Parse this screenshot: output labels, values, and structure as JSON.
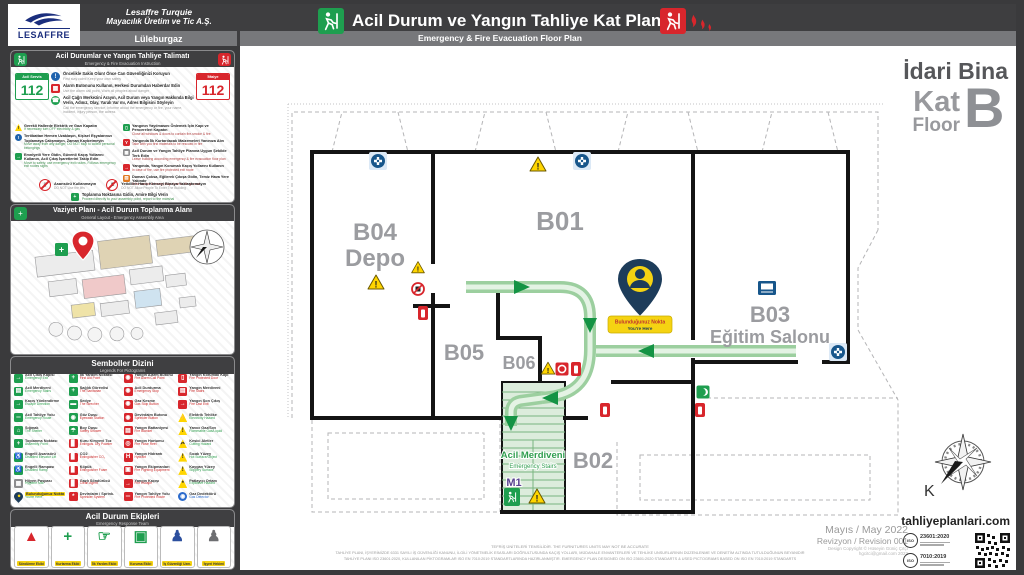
{
  "header": {
    "logo_text": "LESAFFRE",
    "company_line1": "Lesaffre Turquie",
    "company_line2": "Mayacılık Üretim ve Tic A.Ş.",
    "location": "Lüleburgaz",
    "title": "Acil Durum ve Yangın Tahliye Kat Planı",
    "subtitle": "Emergency & Fire Evacuation Floor Plan"
  },
  "building": {
    "name": "İdari Bina",
    "kat": "Kat",
    "floor": "Floor",
    "code": "B"
  },
  "instructions": {
    "title": "Acil Durumlar ve Yangın Tahliye Talimatı",
    "subtitle": "Emergency & Fire Evacuation Instruction",
    "numbers": [
      {
        "label": "Acil Servis",
        "number": "112",
        "c": "#1e9e4f"
      },
      {
        "label": "İtfaiye",
        "number": "112",
        "c": "#d8262c"
      }
    ],
    "steps": [
      {
        "tr": "Öncelikle Sakin Olun! Önce Can Güvenliğinizi Koruyun",
        "en": "First stay calm! Keep your own safety",
        "g": "!",
        "c": "#1f63ad",
        "t": "circ"
      },
      {
        "tr": "Alarm Butonunu Kullanın, Herkesi Durumdan Haberdar Edin",
        "en": "Use the alarm call point, Warn all peoples about danger",
        "g": "▦",
        "c": "#d8262c",
        "t": "sq"
      },
      {
        "tr": "Acil Çağrı Merkezini Arayın, Acil Durum veya Yangın Hakkında Bilgi Verin, Adınız, Olay, Yaralı Var mı, Adres Bilgisini Söyleyin",
        "en": "Call the emergency service, Informe about the emergency or fire, your name, incident, injury person, the adress",
        "g": "☎",
        "c": "#1e9e4f",
        "t": "circ"
      }
    ],
    "notes_left": [
      {
        "tr": "Gerekli Hallerde Elektrik ve Gazı Kapatın",
        "en": "If necessary turn OFF electricity & gas",
        "g": "!",
        "c": "#ffd500",
        "t": "tri"
      },
      {
        "tr": "Tertibattan Hemen Uzaklaşın, Kişisel Eşyalarınızı Toplamaya Çalışmayın, Zaman Kaybetmeyin",
        "en": "Move away from any danger, DO NOT stop to collect personal belongings",
        "g": "!",
        "c": "#1f63ad",
        "t": "circ"
      },
      {
        "tr": "Emniyetli Yere Gidin, Güvenli Kaçış Yollarını Kullanın, Acil Çıkış İşaretlerini Takip Edin",
        "en": "Move to safety, use emergency exit routes, Follows emergency exit routes signs",
        "g": "→",
        "c": "#1e9e4f",
        "t": "sq"
      }
    ],
    "notes_right": [
      {
        "tr": "Yangının Yayılmasını Önlemek İçin Kapı ve Pencereleri Kapatın",
        "en": "Close all windows & doors to contain fire-smoke & fire",
        "g": "▯",
        "c": "#1e9e4f",
        "t": "sq"
      },
      {
        "tr": "Yangında İlk Kurtarılacak Malzemeleri Yanınıza Alın",
        "en": "Take with you first materials to be rescued in fire",
        "g": "Y",
        "c": "#d8262c",
        "t": "sq"
      },
      {
        "tr": "Acil Durum ve Yangın Tahliye Planına Uygun Şekilde Terk Edin",
        "en": "Leave building according emergency & fire evacuation floor plan",
        "g": "▦",
        "c": "#8d8d8f",
        "t": "sq"
      },
      {
        "tr": "Yangında, Yangın Korumalı Kaçış Yollarını Kullanın",
        "en": "In case of fire, use fire protected exit route",
        "g": "→",
        "c": "#d8262c",
        "t": "sq"
      },
      {
        "tr": "Duman Çoksa, Eğilerek Çıkışa Gidin, Temiz Hava Yere Yakındır",
        "en": "If the smoke is heavy, stay close to the ground",
        "g": "▨",
        "c": "#e07820",
        "t": "sq"
      }
    ],
    "prohibitions": [
      {
        "tr": "Asansörü Kullanmayın",
        "en": "DO NOT Use the lifts",
        "g": "▯"
      },
      {
        "tr": "Yetkililer Hariç Kimseyi Binaya Yaklaştırmayın",
        "en": "DO NOT Allow People To Enter The Building",
        "g": "♟"
      }
    ],
    "assembly": {
      "tr": "Toplanma Noktasına Gidin, Amire Bilgi Verin",
      "en": "Proceed directly to your assembly point, report to the marshal"
    }
  },
  "site_panel": {
    "title": "Vaziyet Planı - Acil Durum Toplanma Alanı",
    "subtitle": "General Layout - Emergency Assembly Area"
  },
  "legend": {
    "title": "Semboller Dizini",
    "subtitle": "Legends For Pictograms",
    "items": [
      {
        "tr": "Acil Çıkış Kapısı",
        "en": "Emergency Exit",
        "t": "sq",
        "c": "#1e9e4f",
        "g": "→",
        "ec": "#2f9e4e"
      },
      {
        "tr": "İlk Yardım Noktası",
        "en": "First Aid Point",
        "t": "sq",
        "c": "#1e9e4f",
        "g": "+",
        "ec": "#cc2a2a"
      },
      {
        "tr": "Yangın Alarm Butonu",
        "en": "Fire Alarm Call Point",
        "t": "sq",
        "c": "#d8262c",
        "g": "◉",
        "ec": "#cc2a2a"
      },
      {
        "tr": "Yangın Korumalı Kapı",
        "en": "Fire Protected Door",
        "t": "sq",
        "c": "#d8262c",
        "g": "▯",
        "ec": "#cc2a2a"
      },
      {
        "tr": "Acil Merdiveni",
        "en": "Emergency Stairs",
        "t": "sq",
        "c": "#1e9e4f",
        "g": "▤",
        "ec": "#2f9e4e"
      },
      {
        "tr": "Sağlık Görevlisi",
        "en": "The Sanitarian",
        "t": "sq",
        "c": "#1e9e4f",
        "g": "+",
        "ec": "#cc2a2a"
      },
      {
        "tr": "Acil Durdurma",
        "en": "Emergency Stop",
        "t": "sq",
        "c": "#d8262c",
        "g": "◉",
        "ec": "#cc2a2a"
      },
      {
        "tr": "Yangın Merdiveni",
        "en": "Fire Stairs",
        "t": "sq",
        "c": "#d8262c",
        "g": "▤",
        "ec": "#cc2a2a"
      },
      {
        "tr": "Kaçış Yönlendirme",
        "en": "Escape Direction",
        "t": "sq",
        "c": "#1e9e4f",
        "g": "→",
        "ec": "#2f9e4e"
      },
      {
        "tr": "Sedye",
        "en": "The Strecher",
        "t": "sq",
        "c": "#1e9e4f",
        "g": "▬",
        "ec": "#cc2a2a"
      },
      {
        "tr": "Gaz Kesme",
        "en": "Gas Stop Button",
        "t": "sq",
        "c": "#d8262c",
        "g": "◉",
        "ec": "#cc2a2a"
      },
      {
        "tr": "Yangın Son Çıkış",
        "en": "Fire Last Exit",
        "t": "sq",
        "c": "#d8262c",
        "g": "→",
        "ec": "#cc2a2a"
      },
      {
        "tr": "Acil Tahliye Yolu",
        "en": "Emergency Route",
        "t": "sq",
        "c": "#1e9e4f",
        "g": "═",
        "ec": "#2f9e4e"
      },
      {
        "tr": "Göz Duşu",
        "en": "Eyewash Station",
        "t": "sq",
        "c": "#1e9e4f",
        "g": "◉",
        "ec": "#cc2a2a"
      },
      {
        "tr": "Devirdaim Butonu",
        "en": "Sprinkler Button",
        "t": "sq",
        "c": "#d8262c",
        "g": "◉",
        "ec": "#cc2a2a"
      },
      {
        "tr": "Elektrik Tehlike",
        "en": "Electricity Hazard",
        "t": "tri",
        "c": "#ffd500",
        "g": "⚡",
        "gc": "#222",
        "ec": "#2f9e4e"
      },
      {
        "tr": "Sığınak",
        "en": "The Shelter",
        "t": "sq",
        "c": "#1e9e4f",
        "g": "⌂",
        "ec": "#2f9e4e"
      },
      {
        "tr": "Boy Duşu",
        "en": "Safety Shower",
        "t": "sq",
        "c": "#1e9e4f",
        "g": "☂",
        "ec": "#cc2a2a"
      },
      {
        "tr": "Yangın Battaniyesi",
        "en": "Fire Blanket",
        "t": "sq",
        "c": "#d8262c",
        "g": "▤",
        "ec": "#cc2a2a"
      },
      {
        "tr": "Yanıcı Gaz/Sıvı",
        "en": "Flammable Gas/Liquid",
        "t": "tri",
        "c": "#ffd500",
        "g": "!",
        "gc": "#222",
        "ec": "#2f9e4e"
      },
      {
        "tr": "Toplanma Noktası",
        "en": "Assembly Point",
        "t": "sq",
        "c": "#1e9e4f",
        "g": "+",
        "ec": "#2f9e4e"
      },
      {
        "tr": "Kuru Kimyevi Toz",
        "en": "Extinguis. Dry Powder",
        "t": "sq",
        "c": "#d8262c",
        "g": "▊",
        "ec": "#cc2a2a"
      },
      {
        "tr": "Yangın Hortumu",
        "en": "Fire Hose Reel",
        "t": "sq",
        "c": "#d8262c",
        "g": "◎",
        "ec": "#cc2a2a"
      },
      {
        "tr": "Kesici Aletler",
        "en": "Cutting Hazard",
        "t": "tri",
        "c": "#ffd500",
        "g": "✂",
        "gc": "#222",
        "ec": "#2f9e4e"
      },
      {
        "tr": "Engelli Asansörü",
        "en": "Disabled Elevator Lift",
        "t": "sq",
        "c": "#1e9e4f",
        "g": "♿",
        "ec": "#2f9e4e"
      },
      {
        "tr": "CO2",
        "en": "Extinguisher CO₂",
        "t": "sq",
        "c": "#d8262c",
        "g": "▊",
        "ec": "#cc2a2a"
      },
      {
        "tr": "Yangın Hidrantı",
        "en": "Hydrant",
        "t": "sq",
        "c": "#d8262c",
        "g": "H",
        "ec": "#cc2a2a"
      },
      {
        "tr": "Sıcak Yüzey",
        "en": "Hot Surface/Object",
        "t": "tri",
        "c": "#ffd500",
        "g": "!",
        "gc": "#222",
        "ec": "#2f9e4e"
      },
      {
        "tr": "Engelli Rampası",
        "en": "Disabled Ramp",
        "t": "sq",
        "c": "#1e9e4f",
        "g": "♿",
        "ec": "#2f9e4e"
      },
      {
        "tr": "Köpük",
        "en": "Extinguisher Foam",
        "t": "sq",
        "c": "#d8262c",
        "g": "▊",
        "ec": "#cc2a2a"
      },
      {
        "tr": "Yangın Ekipmanları",
        "en": "Fire Fighting Equipment",
        "t": "sq",
        "c": "#d8262c",
        "g": "▣",
        "ec": "#cc2a2a"
      },
      {
        "tr": "Kaygan Yüzey",
        "en": "Slippery Surface",
        "t": "tri",
        "c": "#ffd500",
        "g": "!",
        "gc": "#222",
        "ec": "#2f9e4e"
      },
      {
        "tr": "Hijyen Paspası",
        "en": "Hygiene Mat",
        "t": "sq",
        "c": "#8d8d8f",
        "g": "▦",
        "ec": "#2f9e4e"
      },
      {
        "tr": "Gazl​ı Söndürücü",
        "en": "Clean Agent",
        "t": "sq",
        "c": "#d8262c",
        "g": "▊",
        "ec": "#cc2a2a"
      },
      {
        "tr": "Yangın Kaçışı",
        "en": "Fire Escape",
        "t": "sq",
        "c": "#d8262c",
        "g": "→",
        "ec": "#cc2a2a"
      },
      {
        "tr": "Patlayıcı Ortam",
        "en": "Explosive Hazard",
        "t": "tri",
        "c": "#ffd500",
        "g": "*",
        "gc": "#222",
        "ec": "#2f9e4e"
      },
      {
        "tr": "Bulunduğunuz Nokta",
        "en": "You're Here",
        "t": "pin",
        "c": "#1d3c5a",
        "g": "●",
        "gc": "#f5d312",
        "ec": "#2f9e4e",
        "tcls": "hl"
      },
      {
        "tr": "Devirdaim / Sprink.",
        "en": "Sprinkler System",
        "t": "sq",
        "c": "#d8262c",
        "g": "*",
        "ec": "#cc2a2a"
      },
      {
        "tr": "Yangın Tahliye Yolu",
        "en": "Fire Protected Route",
        "t": "sq",
        "c": "#d8262c",
        "g": "═",
        "ec": "#cc2a2a"
      },
      {
        "tr": "Gaz Dedektörü",
        "en": "Gas Detector",
        "t": "circ",
        "c": "#2a6acc",
        "g": "◉",
        "ec": "#2a6acc"
      }
    ]
  },
  "team": {
    "title": "Acil Durum Ekipleri",
    "subtitle": "Emergency Response Team",
    "members": [
      {
        "label": "Söndürme Ekibi",
        "g": "▲",
        "c": "#d8262c"
      },
      {
        "label": "Kurtarma Ekibi",
        "g": "+",
        "c": "#1e9e4f"
      },
      {
        "label": "İlk Yardım Ekibi",
        "g": "☞",
        "c": "#1e9e4f"
      },
      {
        "label": "Koruma Ekibi",
        "g": "▣",
        "c": "#1e9e4f"
      },
      {
        "label": "İş Güvenliği Uzm.",
        "g": "♟",
        "c": "#2c4f9e"
      },
      {
        "label": "İşyeri Hekimi",
        "g": "♟",
        "c": "#6d6e71"
      }
    ]
  },
  "plan": {
    "rooms": [
      {
        "id": "B04",
        "name": "Depo"
      },
      {
        "id": "B01",
        "name": ""
      },
      {
        "id": "B03",
        "name": "Eğitim Salonu"
      },
      {
        "id": "B05",
        "name": ""
      },
      {
        "id": "B06",
        "name": ""
      },
      {
        "id": "B02",
        "name": ""
      }
    ],
    "stairs": {
      "tr": "Acil Merdiveni",
      "en": "Emergency Stairs",
      "code": "M1"
    },
    "you_are_here": {
      "tr": "Bulunduğunuz Nokta",
      "en": "You're Here"
    },
    "compass": "K"
  },
  "footer": {
    "disclaimer1": "TEFRİŞ ÜNİTELERİ TEMSİLİDİR.  THE FURNITURES UNITS MAY NOT BE ACCURATE",
    "disclaimer2": "TAHLİYE PLANI, İŞYERİMİZDE 6331 SAYILI İŞ GÜVENLİĞİ KANUNU, İLGİLİ YÖNETMELİK ESASLARI DOĞRULTUSUNDA KAÇIŞ YOLLARI, MÜDAHALE ENVANTERLERİ VE TEHLİKE UNSURLARININ DÜZENLENME VE DENETİM ALTINDA TUTULDUĞUNUN BEYANIDIR",
    "disclaimer3": "TAHLİYE PLANI ISO 23601:2020, KULLANILAN PİKTOGRAMLAR ISO EN 7010:2019 STANDARTLARINDA HAZIRLANMIŞTIR.   EMERGENCY PLAN DESIGNED ON ISO 23601:2020 STANDARTS & USED PICTOGRAMS BASED ON ISO EN 7010:2019 STANDARTS",
    "date": "Mayıs / May 2022",
    "revision": "Revizyon / Revision  001",
    "copyright": "Design Copyright © Hüseyin Güniç Çıtçı",
    "email": "hgcitci@gmail.com 2022",
    "website": "tahliyeplanlari.com",
    "iso_label": "ISO",
    "iso1": "23601:2020",
    "iso2": "7010:2019"
  }
}
